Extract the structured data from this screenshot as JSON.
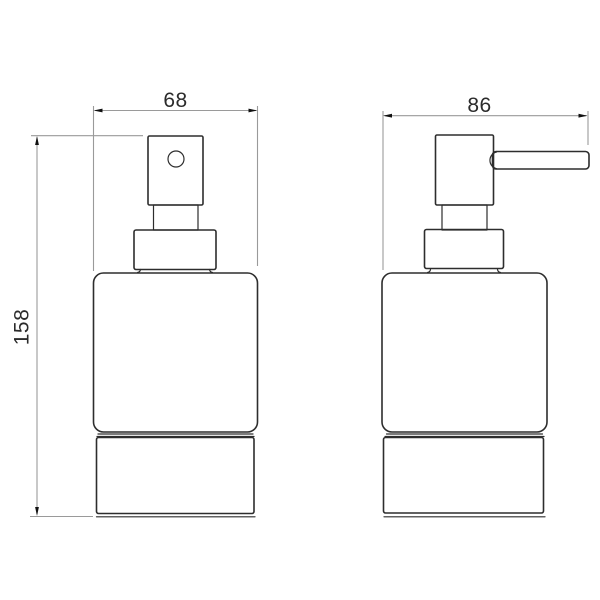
{
  "colors": {
    "background": "#ffffff",
    "outline": "#2d2d2d",
    "dim_line": "#9a9a9a",
    "arrow": "#111111",
    "dim_text": "#2b2b2b"
  },
  "drawing": {
    "type": "technical-dimension-drawing",
    "subject": "soap-dispenser",
    "front_view": {
      "width_dim": "68",
      "height_dim": "158"
    },
    "side_view": {
      "depth_dim": "86"
    }
  }
}
